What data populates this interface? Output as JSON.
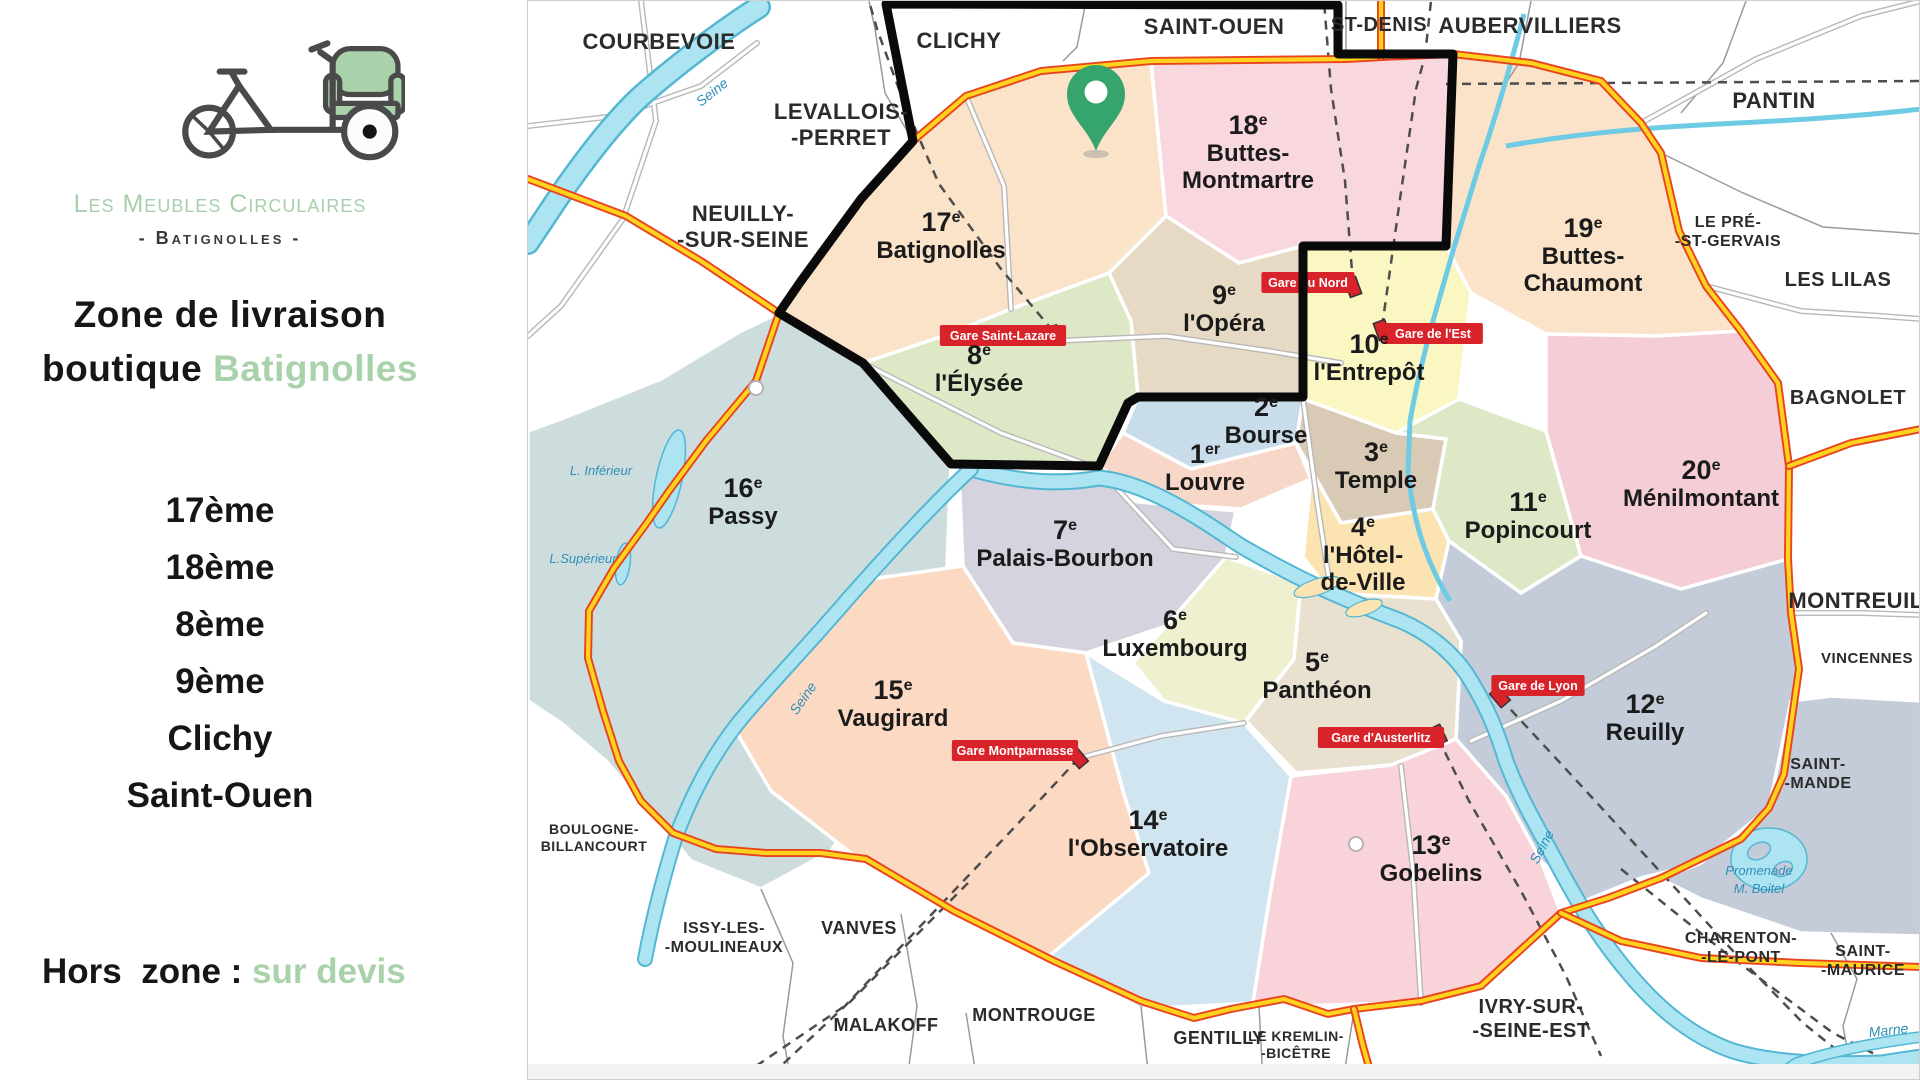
{
  "sidebar": {
    "brand_name": "Les Meubles Circulaires",
    "brand_location": "- Batignolles -",
    "heading_line1": "Zone de livraison",
    "heading_line2_prefix": "boutique ",
    "heading_line2_highlight": "Batignolles",
    "zones": [
      "17ème",
      "18ème",
      "8ème",
      "9ème",
      "Clichy",
      "Saint-Ouen"
    ],
    "footer_prefix": "Hors  zone : ",
    "footer_highlight": "sur devis"
  },
  "colors": {
    "accent_green": "#a9d2ab",
    "pin_green": "#35a56d",
    "gare_red": "#d8232a",
    "zone_outline": "#0a0a0a",
    "ring_road_yellow": "#ffd21e",
    "ring_road_red": "#e8441f",
    "river_blue": "#ace4f2"
  },
  "map": {
    "districts": [
      {
        "id": "17",
        "num": "17",
        "sup": "e",
        "name": [
          "Batignolles"
        ],
        "color": "#fae3c8",
        "label": [
          940,
          230
        ],
        "points": "778,312 800,280 860,198 912,140 965,95 1050,68 1150,60 1165,215 1108,272 1010,308 948,333 862,362"
      },
      {
        "id": "18",
        "num": "18",
        "sup": "e",
        "name": [
          "Buttes-",
          "Montmartre"
        ],
        "color": "#f9d7df",
        "label": [
          1247,
          133
        ],
        "points": "1150,60 1452,55 1445,245 1302,245 1238,262 1165,215"
      },
      {
        "id": "19",
        "num": "19",
        "sup": "e",
        "name": [
          "Buttes-",
          "Chaumont"
        ],
        "color": "#fae3c8",
        "label": [
          1582,
          236
        ],
        "points": "1452,55 1530,62 1600,82 1640,122 1660,152 1678,230 1705,285 1740,330 1655,335 1545,333 1470,292 1445,245"
      },
      {
        "id": "10",
        "num": "10",
        "sup": "e",
        "name": [
          "l'Entrepôt"
        ],
        "color": "#faf7c3",
        "label": [
          1368,
          352
        ],
        "points": "1302,245 1445,245 1470,292 1458,398 1395,432 1302,398"
      },
      {
        "id": "9",
        "num": "9",
        "sup": "e",
        "name": [
          "l'Opéra"
        ],
        "color": "#e7dac4",
        "label": [
          1223,
          303
        ],
        "points": "1165,215 1238,262 1302,245 1302,398 1137,396 1130,320 1108,272"
      },
      {
        "id": "8",
        "num": "8",
        "sup": "e",
        "name": [
          "l'Élysée"
        ],
        "color": "#dde9c6",
        "label": [
          978,
          363
        ],
        "points": "862,362 948,333 1010,308 1108,272 1130,320 1137,396 1127,402 1098,465 950,463"
      },
      {
        "id": "2",
        "num": "2",
        "sup": "e",
        "name": [
          "Bourse"
        ],
        "color": "#c8dcea",
        "label": [
          1265,
          415
        ],
        "points": "1137,396 1302,398 1295,442 1190,468 1122,432"
      },
      {
        "id": "3",
        "num": "3",
        "sup": "e",
        "name": [
          "Temple"
        ],
        "color": "#d9cab6",
        "label": [
          1375,
          460
        ],
        "points": "1302,398 1395,432 1445,438 1432,508 1340,522 1295,442"
      },
      {
        "id": "1",
        "num": "1",
        "sup": "er",
        "name": [
          "Louvre"
        ],
        "color": "#f7d8c8",
        "label": [
          1204,
          462
        ],
        "points": "1098,465 1122,432 1190,468 1295,442 1310,478 1240,508 1150,502"
      },
      {
        "id": "4",
        "num": "4",
        "sup": "e",
        "name": [
          "l'Hôtel-",
          "de-Ville"
        ],
        "color": "#fbe3b2",
        "label": [
          1362,
          535
        ],
        "points": "1295,442 1310,478 1302,556 1330,592 1435,598 1448,540 1432,508 1340,522"
      },
      {
        "id": "11",
        "num": "11",
        "sup": "e",
        "name": [
          "Popincourt"
        ],
        "color": "#dde9c6",
        "label": [
          1527,
          510
        ],
        "points": "1395,432 1458,398 1545,430 1580,555 1520,592 1448,540 1432,508 1445,438"
      },
      {
        "id": "20",
        "num": "20",
        "sup": "e",
        "name": [
          "Ménilmontant"
        ],
        "color": "#f5cdd6",
        "label": [
          1700,
          478
        ],
        "points": "1545,333 1655,335 1740,330 1777,382 1788,465 1787,558 1680,588 1580,555 1545,430"
      },
      {
        "id": "12",
        "num": "12",
        "sup": "e",
        "name": [
          "Reuilly"
        ],
        "color": "#c3ccd8",
        "label": [
          1644,
          712
        ],
        "points": "1448,540 1520,592 1580,555 1680,588 1787,558 1790,612 1798,668 1783,773 1768,807 1700,862 1640,877 1583,900 1540,860 1505,795 1455,738 1460,640 1435,598"
      },
      {
        "id": "16",
        "num": "16",
        "sup": "e",
        "name": [
          "Passy"
        ],
        "color": "#cdddde",
        "label": [
          742,
          496
        ],
        "points": "862,362 778,312 740,330 660,378 560,418 527,430 527,700 560,722 605,760 640,800 690,860 760,888 830,850 900,740 945,590 950,463"
      },
      {
        "id": "7",
        "num": "7",
        "sup": "e",
        "name": [
          "Palais-Bourbon"
        ],
        "color": "#d5d3de",
        "label": [
          1064,
          538
        ],
        "points": "958,472 1098,470 1128,500 1235,510 1225,556 1165,625 1085,652 1012,642 962,565"
      },
      {
        "id": "6",
        "num": "6",
        "sup": "e",
        "name": [
          "Luxembourg"
        ],
        "color": "#eef0d0",
        "label": [
          1174,
          628
        ],
        "points": "1165,625 1225,556 1300,582 1293,658 1243,722 1163,700 1132,662"
      },
      {
        "id": "5",
        "num": "5",
        "sup": "e",
        "name": [
          "Panthéon"
        ],
        "color": "#e8e1cf",
        "label": [
          1316,
          670
        ],
        "points": "1300,582 1330,592 1435,598 1460,640 1455,738 1390,764 1295,772 1245,720 1293,658"
      },
      {
        "id": "15",
        "num": "15",
        "sup": "e",
        "name": [
          "Vaugirard"
        ],
        "color": "#fcd9c3",
        "label": [
          892,
          698
        ],
        "points": "962,565 1012,642 1085,652 1122,790 1148,872 1050,958 948,908 850,852 770,790 735,730 800,650 870,578"
      },
      {
        "id": "14",
        "num": "14",
        "sup": "e",
        "name": [
          "l'Observatoire"
        ],
        "color": "#d0e5ef",
        "label": [
          1147,
          828
        ],
        "points": "1085,652 1163,700 1243,722 1290,775 1268,900 1252,1002 1140,1008 1048,955 1148,872 1122,790"
      },
      {
        "id": "13",
        "num": "13",
        "sup": "e",
        "name": [
          "Gobelins"
        ],
        "color": "#f8d3da",
        "label": [
          1430,
          853
        ],
        "points": "1290,775 1390,764 1455,738 1505,795 1540,860 1560,912 1480,985 1400,1002 1290,1005 1252,1002 1268,900"
      },
      {
        "id": "bois-vincennes",
        "num": "",
        "sup": "",
        "name": [],
        "color": "#c3ccd8",
        "label": [
          0,
          0
        ],
        "points": "1768,807 1790,700 1830,695 1920,700 1920,935 1800,932 1700,898 1660,878 1700,862"
      }
    ],
    "suburbs": [
      {
        "lines": [
          "COURBEVOIE"
        ],
        "x": 658,
        "y": 48,
        "size": 22
      },
      {
        "lines": [
          "CLICHY"
        ],
        "x": 958,
        "y": 47,
        "size": 22
      },
      {
        "lines": [
          "SAINT-OUEN"
        ],
        "x": 1213,
        "y": 33,
        "size": 22
      },
      {
        "lines": [
          "ST-DENIS"
        ],
        "x": 1378,
        "y": 30,
        "size": 20
      },
      {
        "lines": [
          "AUBERVILLIERS"
        ],
        "x": 1529,
        "y": 32,
        "size": 22
      },
      {
        "lines": [
          "PANTIN"
        ],
        "x": 1773,
        "y": 107,
        "size": 22
      },
      {
        "lines": [
          "LEVALLOIS-",
          "-PERRET"
        ],
        "x": 840,
        "y": 118,
        "size": 22
      },
      {
        "lines": [
          "NEUILLY-",
          "-SUR-SEINE"
        ],
        "x": 742,
        "y": 220,
        "size": 22
      },
      {
        "lines": [
          "LE PRÉ-",
          "-ST-GERVAIS"
        ],
        "x": 1727,
        "y": 226,
        "size": 16
      },
      {
        "lines": [
          "LES LILAS"
        ],
        "x": 1837,
        "y": 285,
        "size": 20
      },
      {
        "lines": [
          "BAGNOLET"
        ],
        "x": 1847,
        "y": 403,
        "size": 20
      },
      {
        "lines": [
          "MONTREUIL"
        ],
        "x": 1855,
        "y": 607,
        "size": 22
      },
      {
        "lines": [
          "VINCENNES"
        ],
        "x": 1866,
        "y": 662,
        "size": 15
      },
      {
        "lines": [
          "SAINT-",
          "-MANDE"
        ],
        "x": 1817,
        "y": 768,
        "size": 16
      },
      {
        "lines": [
          "CHARENTON-",
          "-LE-PONT"
        ],
        "x": 1740,
        "y": 942,
        "size": 16
      },
      {
        "lines": [
          "SAINT-",
          "-MAURICE"
        ],
        "x": 1862,
        "y": 955,
        "size": 16
      },
      {
        "lines": [
          "IVRY-SUR-",
          "-SEINE-EST"
        ],
        "x": 1530,
        "y": 1012,
        "size": 20
      },
      {
        "lines": [
          "LE KREMLIN-",
          "-BICÊTRE"
        ],
        "x": 1295,
        "y": 1040,
        "size": 14
      },
      {
        "lines": [
          "GENTILLY"
        ],
        "x": 1218,
        "y": 1043,
        "size": 18
      },
      {
        "lines": [
          "MONTROUGE"
        ],
        "x": 1033,
        "y": 1020,
        "size": 18
      },
      {
        "lines": [
          "MALAKOFF"
        ],
        "x": 885,
        "y": 1030,
        "size": 18
      },
      {
        "lines": [
          "VANVES"
        ],
        "x": 858,
        "y": 933,
        "size": 18
      },
      {
        "lines": [
          "ISSY-LES-",
          "-MOULINEAUX"
        ],
        "x": 723,
        "y": 932,
        "size": 16
      },
      {
        "lines": [
          "BOULOGNE-",
          "BILLANCOURT"
        ],
        "x": 593,
        "y": 833,
        "size": 14
      }
    ],
    "water_labels": [
      {
        "lines": [
          "Seine"
        ],
        "x": 714,
        "y": 95,
        "rot": -38,
        "size": 14
      },
      {
        "lines": [
          "Seine"
        ],
        "x": 806,
        "y": 700,
        "rot": -55,
        "size": 14
      },
      {
        "lines": [
          "Seine"
        ],
        "x": 1545,
        "y": 848,
        "rot": -62,
        "size": 14
      },
      {
        "lines": [
          "Marne"
        ],
        "x": 1888,
        "y": 1034,
        "rot": -6,
        "size": 14
      },
      {
        "lines": [
          "L. Inférieur"
        ],
        "x": 600,
        "y": 474,
        "rot": 0,
        "size": 13
      },
      {
        "lines": [
          "L.Supérieur"
        ],
        "x": 582,
        "y": 562,
        "rot": 0,
        "size": 13
      },
      {
        "lines": [
          "Promenade",
          "M. Boitel"
        ],
        "x": 1758,
        "y": 874,
        "rot": 0,
        "size": 13
      }
    ],
    "gares": [
      {
        "name": "Gare Saint-Lazare",
        "bx": 1002,
        "by": 335,
        "mx": 1052,
        "my": 334,
        "rot": -15
      },
      {
        "name": "Gare du Nord",
        "bx": 1307,
        "by": 282,
        "mx": 1352,
        "my": 286,
        "rot": -20
      },
      {
        "name": "Gare de l'Est",
        "bx": 1432,
        "by": 333,
        "mx": 1381,
        "my": 329,
        "rot": -20
      },
      {
        "name": "Gare de Lyon",
        "bx": 1537,
        "by": 685,
        "mx": 1499,
        "my": 696,
        "rot": -40
      },
      {
        "name": "Gare d'Austerlitz",
        "bx": 1380,
        "by": 737,
        "mx": 1437,
        "my": 734,
        "rot": -25
      },
      {
        "name": "Gare Montparnasse",
        "bx": 1014,
        "by": 750,
        "mx": 1077,
        "my": 757,
        "rot": -40
      }
    ],
    "pin": {
      "x": 1095,
      "y": 93
    },
    "zone_outline": "885,3 1337,4 1337,53 1452,53 1445,245 1302,245 1302,396 1137,396 1127,402 1098,465 950,463 862,362 778,312 800,280 860,198 912,140"
  }
}
